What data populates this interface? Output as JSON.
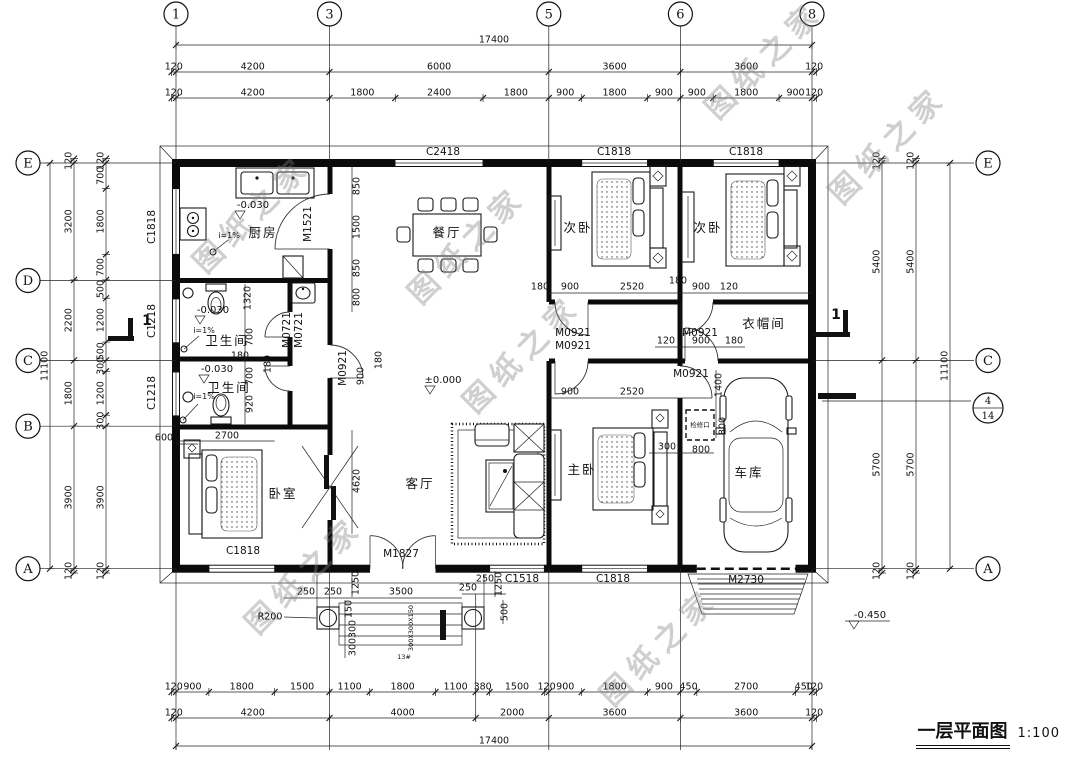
{
  "title": {
    "name": "一层平面图",
    "scale": "1:100"
  },
  "watermark": {
    "text": "图纸之家",
    "spots": [
      [
        250,
        212
      ],
      [
        465,
        243
      ],
      [
        762,
        58
      ],
      [
        520,
        352
      ],
      [
        302,
        573
      ],
      [
        657,
        645
      ],
      [
        886,
        143
      ]
    ]
  },
  "grid": {
    "top": [
      "1",
      "3",
      "5",
      "6",
      "8"
    ],
    "left": [
      "E",
      "D",
      "C",
      "B",
      "A"
    ],
    "right": [
      "E",
      "C",
      "A"
    ],
    "detail": {
      "top": "4",
      "bottom": "14"
    }
  },
  "dims": {
    "top_total": [
      "17400"
    ],
    "top_major": [
      "120",
      "4200",
      "6000",
      "3600",
      "3600",
      "120"
    ],
    "top_minor": [
      "120",
      "4200",
      "1800",
      "2400",
      "1800",
      "900",
      "1800",
      "900",
      "900",
      "1800",
      "900",
      "120"
    ],
    "bottom_minor": [
      "120",
      "900",
      "1800",
      "1500",
      "1100",
      "1800",
      "1100",
      "380",
      "1500",
      "120",
      "900",
      "1800",
      "900",
      "450",
      "2700",
      "450",
      "120"
    ],
    "bottom_major": [
      "120",
      "4200",
      "4000",
      "2000",
      "3600",
      "3600",
      "120"
    ],
    "bottom_total": [
      "17400"
    ],
    "left_outer": [
      "120",
      "3200",
      "2200",
      "1800",
      "3900",
      "120"
    ],
    "left_inner": [
      "120",
      "700",
      "1800",
      "700",
      "500",
      "1200",
      "500",
      "300",
      "1200",
      "300",
      "3900",
      "120"
    ],
    "left_total": [
      "11100"
    ],
    "right_outer": [
      "120",
      "5400",
      "5700",
      "120"
    ],
    "right_inner": [
      "120",
      "5400",
      "5700",
      "120"
    ],
    "right_total": [
      "11100"
    ]
  },
  "annotations": [
    {
      "t": "厨房",
      "x": 263,
      "y": 233,
      "c": "rm"
    },
    {
      "t": "餐厅",
      "x": 447,
      "y": 233,
      "c": "rm"
    },
    {
      "t": "次卧",
      "x": 578,
      "y": 228,
      "c": "rm"
    },
    {
      "t": "次卧",
      "x": 708,
      "y": 228,
      "c": "rm"
    },
    {
      "t": "衣帽间",
      "x": 764,
      "y": 324,
      "c": "rm"
    },
    {
      "t": "卫生间",
      "x": 227,
      "y": 341,
      "c": "rm"
    },
    {
      "t": "卫生间",
      "x": 229,
      "y": 388,
      "c": "rm"
    },
    {
      "t": "卧室",
      "x": 283,
      "y": 494,
      "c": "rm"
    },
    {
      "t": "客厅",
      "x": 420,
      "y": 484,
      "c": "rm"
    },
    {
      "t": "主卧",
      "x": 582,
      "y": 470,
      "c": "rm"
    },
    {
      "t": "车库",
      "x": 749,
      "y": 473,
      "c": "rm"
    },
    {
      "t": "-0.030",
      "x": 253,
      "y": 206,
      "c": "lv"
    },
    {
      "t": "-0.030",
      "x": 213,
      "y": 311,
      "c": "lv"
    },
    {
      "t": "-0.030",
      "x": 217,
      "y": 370,
      "c": "lv"
    },
    {
      "t": "±0.000",
      "x": 443,
      "y": 381,
      "c": "lv"
    },
    {
      "t": "-0.450",
      "x": 870,
      "y": 616,
      "c": "lv"
    },
    {
      "t": "i=1%",
      "x": 229,
      "y": 236,
      "c": "sl"
    },
    {
      "t": "i=1%",
      "x": 204,
      "y": 331,
      "c": "sl"
    },
    {
      "t": "i=1%",
      "x": 204,
      "y": 397,
      "c": "sl"
    },
    {
      "t": "C2418",
      "x": 443,
      "y": 152,
      "c": "tg"
    },
    {
      "t": "C1818",
      "x": 614,
      "y": 152,
      "c": "tg"
    },
    {
      "t": "C1818",
      "x": 746,
      "y": 152,
      "c": "tg"
    },
    {
      "t": "C1818",
      "x": 152,
      "y": 227,
      "r": 1,
      "c": "tg"
    },
    {
      "t": "C1218",
      "x": 152,
      "y": 321,
      "r": 1,
      "c": "tg"
    },
    {
      "t": "C1218",
      "x": 152,
      "y": 393,
      "r": 1,
      "c": "tg"
    },
    {
      "t": "C1818",
      "x": 243,
      "y": 551,
      "c": "tg"
    },
    {
      "t": "M1827",
      "x": 401,
      "y": 554,
      "c": "tg"
    },
    {
      "t": "C1518",
      "x": 522,
      "y": 579,
      "c": "tg"
    },
    {
      "t": "C1818",
      "x": 613,
      "y": 579,
      "c": "tg"
    },
    {
      "t": "M2730",
      "x": 746,
      "y": 580,
      "c": "tg"
    },
    {
      "t": "M1521",
      "x": 308,
      "y": 224,
      "r": 1,
      "c": "tg"
    },
    {
      "t": "M0721",
      "x": 287,
      "y": 330,
      "r": 1,
      "c": "tg"
    },
    {
      "t": "M0721",
      "x": 299,
      "y": 330,
      "r": 1,
      "c": "tg"
    },
    {
      "t": "M0921",
      "x": 343,
      "y": 368,
      "r": 1,
      "c": "tg"
    },
    {
      "t": "M0921",
      "x": 573,
      "y": 333,
      "c": "tg"
    },
    {
      "t": "M0921",
      "x": 573,
      "y": 346,
      "c": "tg"
    },
    {
      "t": "M0921",
      "x": 700,
      "y": 333,
      "c": "tg"
    },
    {
      "t": "M0921",
      "x": 691,
      "y": 374,
      "c": "tg"
    },
    {
      "t": "检修口",
      "x": 700,
      "y": 425,
      "c": "sm"
    },
    {
      "t": "850",
      "x": 357,
      "y": 186,
      "r": 1,
      "c": "dm"
    },
    {
      "t": "1500",
      "x": 357,
      "y": 227,
      "r": 1,
      "c": "dm"
    },
    {
      "t": "850",
      "x": 357,
      "y": 268,
      "r": 1,
      "c": "dm"
    },
    {
      "t": "800",
      "x": 357,
      "y": 297,
      "r": 1,
      "c": "dm"
    },
    {
      "t": "1320",
      "x": 248,
      "y": 298,
      "r": 1,
      "c": "dm"
    },
    {
      "t": "700",
      "x": 250,
      "y": 337,
      "r": 1,
      "c": "dm"
    },
    {
      "t": "180",
      "x": 240,
      "y": 356,
      "c": "dm"
    },
    {
      "t": "180",
      "x": 268,
      "y": 364,
      "r": 1,
      "c": "dm"
    },
    {
      "t": "700",
      "x": 250,
      "y": 376,
      "r": 1,
      "c": "dm"
    },
    {
      "t": "920",
      "x": 250,
      "y": 404,
      "r": 1,
      "c": "dm"
    },
    {
      "t": "2700",
      "x": 227,
      "y": 436,
      "c": "dm"
    },
    {
      "t": "600",
      "x": 164,
      "y": 438,
      "c": "dm"
    },
    {
      "t": "180",
      "x": 540,
      "y": 287,
      "c": "dm"
    },
    {
      "t": "900",
      "x": 570,
      "y": 287,
      "c": "dm"
    },
    {
      "t": "2520",
      "x": 632,
      "y": 287,
      "c": "dm"
    },
    {
      "t": "180",
      "x": 678,
      "y": 281,
      "c": "dm"
    },
    {
      "t": "900",
      "x": 701,
      "y": 287,
      "c": "dm"
    },
    {
      "t": "120",
      "x": 729,
      "y": 287,
      "c": "dm"
    },
    {
      "t": "120",
      "x": 666,
      "y": 341,
      "c": "dm"
    },
    {
      "t": "900",
      "x": 701,
      "y": 341,
      "c": "dm"
    },
    {
      "t": "180",
      "x": 734,
      "y": 341,
      "c": "dm"
    },
    {
      "t": "180",
      "x": 379,
      "y": 360,
      "r": 1,
      "c": "dm"
    },
    {
      "t": "900",
      "x": 361,
      "y": 376,
      "r": 1,
      "c": "dm"
    },
    {
      "t": "900",
      "x": 570,
      "y": 392,
      "c": "dm"
    },
    {
      "t": "2520",
      "x": 632,
      "y": 392,
      "c": "dm"
    },
    {
      "t": "300",
      "x": 667,
      "y": 447,
      "c": "dm"
    },
    {
      "t": "800",
      "x": 701,
      "y": 450,
      "c": "dm"
    },
    {
      "t": "1400",
      "x": 719,
      "y": 385,
      "r": 1,
      "c": "dm"
    },
    {
      "t": "800",
      "x": 723,
      "y": 426,
      "r": 1,
      "c": "dm"
    },
    {
      "t": "4620",
      "x": 357,
      "y": 481,
      "r": 1,
      "c": "dm"
    },
    {
      "t": "250",
      "x": 306,
      "y": 592,
      "c": "dm"
    },
    {
      "t": "250",
      "x": 333,
      "y": 592,
      "c": "dm"
    },
    {
      "t": "1250",
      "x": 356,
      "y": 583,
      "r": 1,
      "c": "dm"
    },
    {
      "t": "3500",
      "x": 401,
      "y": 592,
      "c": "dm"
    },
    {
      "t": "250",
      "x": 468,
      "y": 588,
      "c": "dm"
    },
    {
      "t": "250",
      "x": 485,
      "y": 579,
      "c": "dm"
    },
    {
      "t": "1250",
      "x": 499,
      "y": 584,
      "r": 1,
      "c": "dm"
    },
    {
      "t": "150",
      "x": 349,
      "y": 609,
      "r": 1,
      "c": "dm"
    },
    {
      "t": "300",
      "x": 353,
      "y": 629,
      "r": 1,
      "c": "dm"
    },
    {
      "t": "300",
      "x": 353,
      "y": 647,
      "r": 1,
      "c": "dm"
    },
    {
      "t": "500",
      "x": 505,
      "y": 612,
      "r": 1,
      "c": "dm"
    },
    {
      "t": "300X300X150",
      "x": 411,
      "y": 628,
      "r": 1,
      "c": "sm"
    },
    {
      "t": "13#",
      "x": 404,
      "y": 657,
      "c": "sm"
    },
    {
      "t": "R200",
      "x": 270,
      "y": 617,
      "c": "dm"
    },
    {
      "t": "1",
      "x": 147,
      "y": 321,
      "c": "sc"
    },
    {
      "t": "1",
      "x": 836,
      "y": 315,
      "c": "sc"
    }
  ]
}
